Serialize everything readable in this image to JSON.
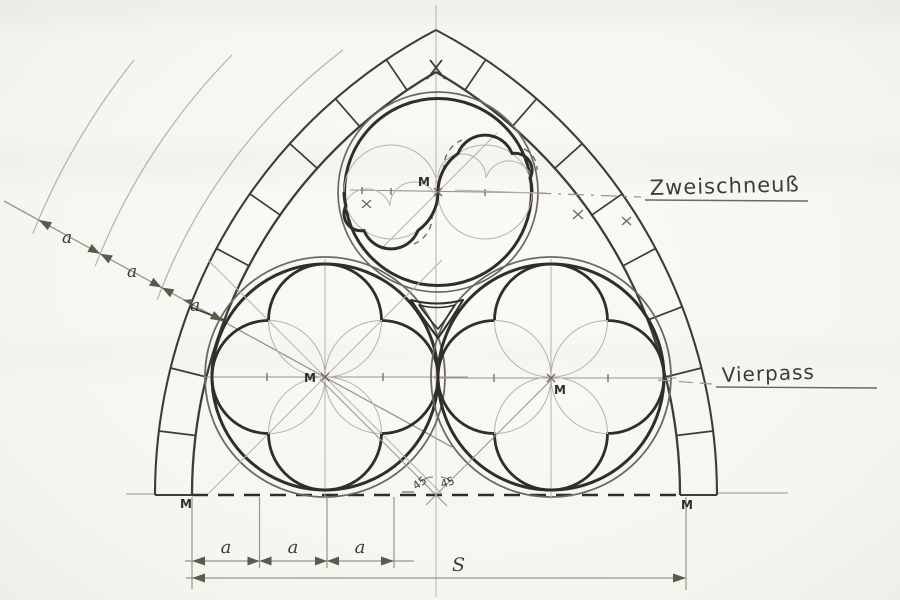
{
  "labels": {
    "zweischneuss": "Zweischneuß",
    "vierpass": "Vierpass",
    "span": "S",
    "center_mark": "M",
    "angle_left": "45",
    "angle_right": "45",
    "diagonal_chain": [
      "a",
      "a",
      "a"
    ],
    "bottom_chain": [
      "a",
      "a",
      "a"
    ]
  },
  "colors": {
    "paper": "#f7f6f2",
    "ink_heavy": "#2f2e29",
    "ink_band": "#3d3c35",
    "ink_medium": "#6b695f",
    "ink_light": "#98958a",
    "ink_faint": "#b5b2a7",
    "arrow": "#5a5b4c"
  },
  "figure": {
    "type": "gothic-tracery-construction-drawing"
  }
}
